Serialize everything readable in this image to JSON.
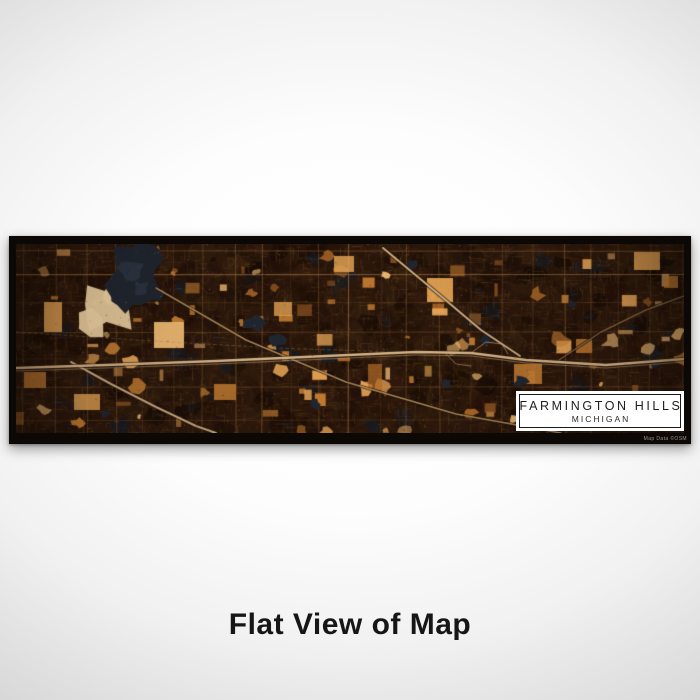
{
  "scene": {
    "caption": "Flat View of Map",
    "background_center": "#ffffff",
    "background_edge": "#d5d5d5"
  },
  "map_print": {
    "frame_color": "#0c0805",
    "label_box": {
      "city": "FARMINGTON HILLS",
      "state": "MICHIGAN",
      "background": "#ffffff",
      "border_color": "#1a1a1a"
    },
    "attribution": "Map Data ©OSM",
    "palette": {
      "base": "#2b170b",
      "base_dark": "#190c04",
      "mottle1": "#33200f",
      "mottle2": "#3a2310",
      "mottle3": "#22100a",
      "streets": "#7d5530",
      "streets_bright": "#9a6c3e",
      "patch_orange": "#c87f33",
      "patch_deep": "#b06a28",
      "patch_bright": "#eaa757",
      "patch_glow": "#f2bd74",
      "patch_cream": "#ecd0a0",
      "water": "#20262f",
      "water_light": "#3c4659",
      "highway": "#d9b587",
      "highway_dim": "#c49a63",
      "rail": "#9a8058",
      "casing": "#120a04"
    }
  }
}
